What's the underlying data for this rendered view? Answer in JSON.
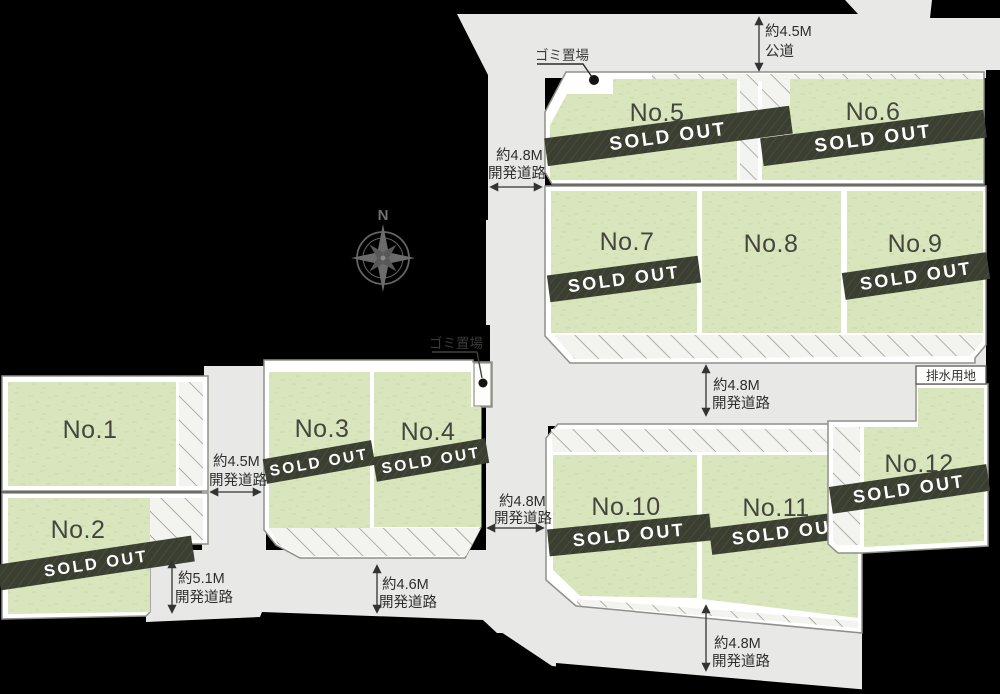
{
  "sold_out_label": "SOLD OUT",
  "compass": {
    "north_label": "N"
  },
  "labels": {
    "garbage_top": "ゴミ置場",
    "garbage_mid": "ゴミ置場",
    "drainage": "排水用地"
  },
  "lots": [
    {
      "number": "No.1",
      "sold": false
    },
    {
      "number": "No.2",
      "sold": true
    },
    {
      "number": "No.3",
      "sold": true
    },
    {
      "number": "No.4",
      "sold": true
    },
    {
      "number": "No.5",
      "sold": true
    },
    {
      "number": "No.6",
      "sold": true
    },
    {
      "number": "No.7",
      "sold": true
    },
    {
      "number": "No.8",
      "sold": false
    },
    {
      "number": "No.9",
      "sold": true
    },
    {
      "number": "No.10",
      "sold": true
    },
    {
      "number": "No.11",
      "sold": true
    },
    {
      "number": "No.12",
      "sold": true
    }
  ],
  "roads": [
    {
      "id": "top-public-road",
      "dim": "約4.5M",
      "type": "公道"
    },
    {
      "id": "upper-left-road",
      "dim": "約4.8M",
      "type": "開発道路"
    },
    {
      "id": "left-road",
      "dim": "約4.5M",
      "type": "開発道路"
    },
    {
      "id": "bottom-left-road",
      "dim": "約5.1M",
      "type": "開発道路"
    },
    {
      "id": "bottom-middle-road",
      "dim": "約4.6M",
      "type": "開発道路"
    },
    {
      "id": "center-road",
      "dim": "約4.8M",
      "type": "開発道路"
    },
    {
      "id": "middle-right-road",
      "dim": "約4.8M",
      "type": "開発道路"
    },
    {
      "id": "bottom-right-road",
      "dim": "約4.8M",
      "type": "開発道路"
    }
  ],
  "colors": {
    "background": "#000000",
    "road": "#e8e9e6",
    "lot_green": "#d9e6bd",
    "hatch_area": "#f3f3f0",
    "sold_band": "#3a3f31",
    "border_white": "#ffffff"
  }
}
